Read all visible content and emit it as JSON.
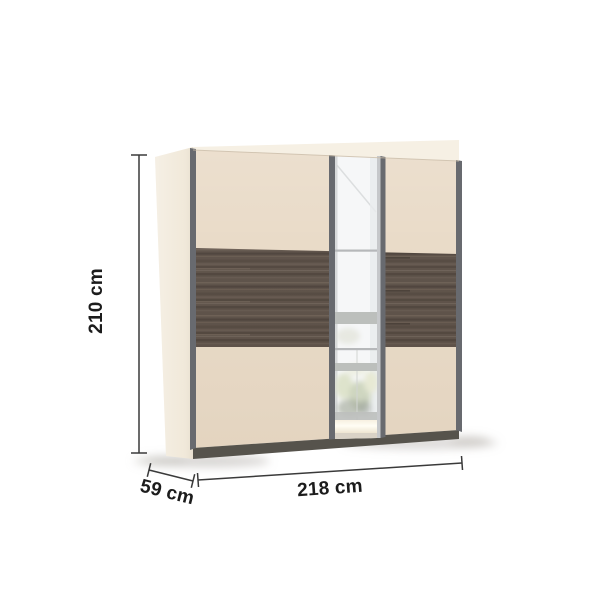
{
  "dimensions": {
    "height_label": "210 cm",
    "width_label": "218 cm",
    "depth_label": "59 cm"
  },
  "colors": {
    "background": "#ffffff",
    "door_beige": "#e8d9c5",
    "side_panel": "#f1e9da",
    "top_face": "#f6f0e4",
    "wood_base": "#594d44",
    "wood_streak_light": "#6f6257",
    "wood_streak_dark": "#463c34",
    "edge_strip": "#686a6f",
    "mirror_frame_light": "#c6c8ca",
    "mirror_base": "#f6f7f8",
    "window_bar": "#bcbfbc",
    "plinth": "#56534c",
    "dimension_line": "#3a3a3a",
    "label_text": "#1c1c1c"
  }
}
